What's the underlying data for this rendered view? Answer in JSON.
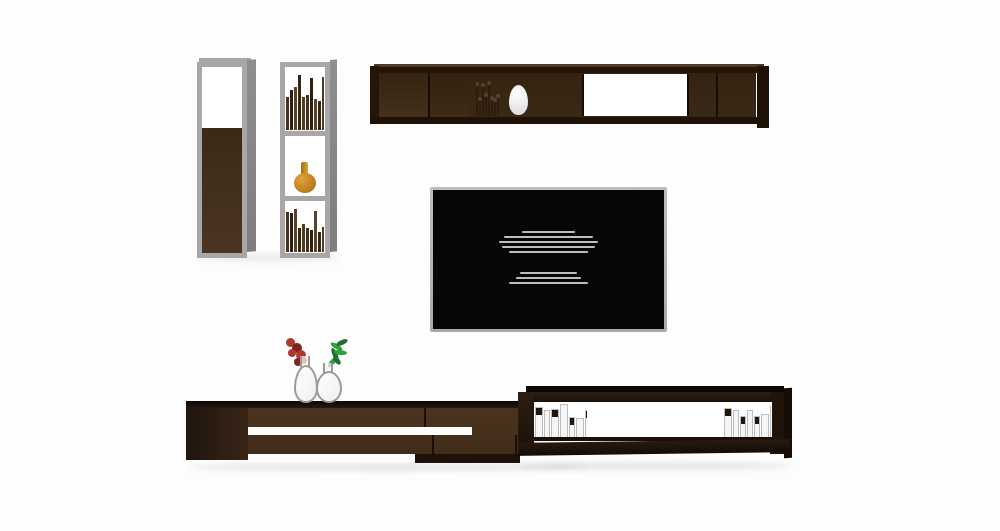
{
  "scene": {
    "kind": "furniture-product-render"
  },
  "colors": {
    "bg": "#fdfdfd",
    "frame_gray": "#a7a7a7",
    "frame_gray_dark": "#8e8e8e",
    "panel_white": "#ffffff",
    "stripe_white": "#fcfcfc",
    "wood_deep": "#241509",
    "wood_dark": "#3b2917",
    "wood_mid": "#4b3522",
    "vase_amber": "#e0a437",
    "vase_amber_dark": "#a96a15",
    "tv_frame": "#bdbdbd",
    "tv_screen": "#060606",
    "tv_text": "#d8d8d8",
    "glass_outline": "#9a9a9a",
    "flower_red": "#ac392c",
    "flower_red_dark": "#7e241c",
    "leaf_green": "#2f9e3f",
    "leaf_green_dark": "#1e6e2c",
    "book_white": "#f5f5f5",
    "book_white_edge": "#bdbdbd"
  },
  "tv_screen": {
    "paragraph1_line_widths_pct": [
      27,
      46,
      51,
      48,
      41
    ],
    "paragraph2_line_widths_pct": [
      29,
      33,
      41
    ]
  },
  "book_groups": {
    "tall_top": {
      "count": 13,
      "style": "dark",
      "min_h": 45,
      "max_h": 92,
      "seed": 3
    },
    "tall_bottom": {
      "count": 13,
      "style": "dark",
      "min_h": 40,
      "max_h": 88,
      "seed": 11
    },
    "wall": {
      "count": 8,
      "style": "stick",
      "min_h": 40,
      "max_h": 92,
      "seed": 5
    },
    "stand_left": {
      "count": 8,
      "style": "white",
      "min_h": 55,
      "max_h": 95,
      "seed": 7
    },
    "stand_right": {
      "count": 9,
      "style": "white",
      "min_h": 55,
      "max_h": 95,
      "seed": 9
    }
  },
  "dark_palette": [
    "#46321c",
    "#2f1f10",
    "#5a422a",
    "#38260f",
    "#503a22"
  ],
  "stick_style": {
    "color": "#2e1d0f",
    "knob": "#5a4026"
  }
}
